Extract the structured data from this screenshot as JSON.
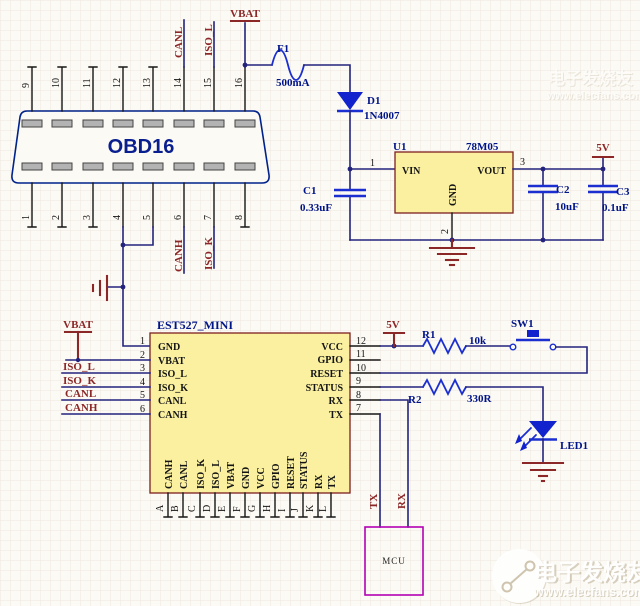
{
  "obd16": {
    "title": "OBD16",
    "top_pins": [
      "9",
      "10",
      "11",
      "12",
      "13",
      "14",
      "15",
      "16"
    ],
    "bottom_pins": [
      "1",
      "2",
      "3",
      "4",
      "5",
      "6",
      "7",
      "8"
    ]
  },
  "nets": {
    "vbat": "VBAT",
    "v5": "5V",
    "canl": "CANL",
    "canh": "CANH",
    "iso_l": "ISO_L",
    "iso_k": "ISO_K",
    "tx": "TX",
    "rx": "RX"
  },
  "power_stage": {
    "fuse_ref": "F1",
    "fuse_value": "500mA",
    "diode_ref": "D1",
    "diode_value": "1N4007",
    "reg_ref": "U1",
    "reg_value": "78M05",
    "reg_vin": "VIN",
    "reg_vout": "VOUT",
    "reg_gnd": "GND",
    "reg_pin1": "1",
    "reg_pin2": "2",
    "reg_pin3": "3",
    "c1_ref": "C1",
    "c1_value": "0.33uF",
    "c2_ref": "C2",
    "c2_value": "10uF",
    "c3_ref": "C3",
    "c3_value": "0.1uF"
  },
  "module": {
    "title": "EST527_MINI",
    "left_pins": [
      {
        "num": "1",
        "name": "GND"
      },
      {
        "num": "2",
        "name": "VBAT"
      },
      {
        "num": "3",
        "name": "ISO_L"
      },
      {
        "num": "4",
        "name": "ISO_K"
      },
      {
        "num": "5",
        "name": "CANL"
      },
      {
        "num": "6",
        "name": "CANH"
      }
    ],
    "right_pins": [
      {
        "num": "12",
        "name": "VCC"
      },
      {
        "num": "11",
        "name": "GPIO"
      },
      {
        "num": "10",
        "name": "RESET"
      },
      {
        "num": "9",
        "name": "STATUS"
      },
      {
        "num": "8",
        "name": "RX"
      },
      {
        "num": "7",
        "name": "TX"
      }
    ],
    "bottom_pins": [
      {
        "des": "A",
        "name": "CANH"
      },
      {
        "des": "B",
        "name": "CANL"
      },
      {
        "des": "C",
        "name": "ISO_K"
      },
      {
        "des": "D",
        "name": "ISO_L"
      },
      {
        "des": "E",
        "name": "VBAT"
      },
      {
        "des": "F",
        "name": "GND"
      },
      {
        "des": "G",
        "name": "VCC"
      },
      {
        "des": "H",
        "name": "GPIO"
      },
      {
        "des": "I",
        "name": "RESET"
      },
      {
        "des": "J",
        "name": "STATUS"
      },
      {
        "des": "K",
        "name": "RX"
      },
      {
        "des": "L",
        "name": "TX"
      }
    ]
  },
  "peripherals": {
    "r1_ref": "R1",
    "r1_value": "10k",
    "sw_ref": "SW1",
    "r2_ref": "R2",
    "r2_value": "330R",
    "led_ref": "LED1",
    "mcu_label": "MCU"
  },
  "watermark": {
    "brand": "电子发烧友",
    "url": "www.elecfans.com"
  }
}
